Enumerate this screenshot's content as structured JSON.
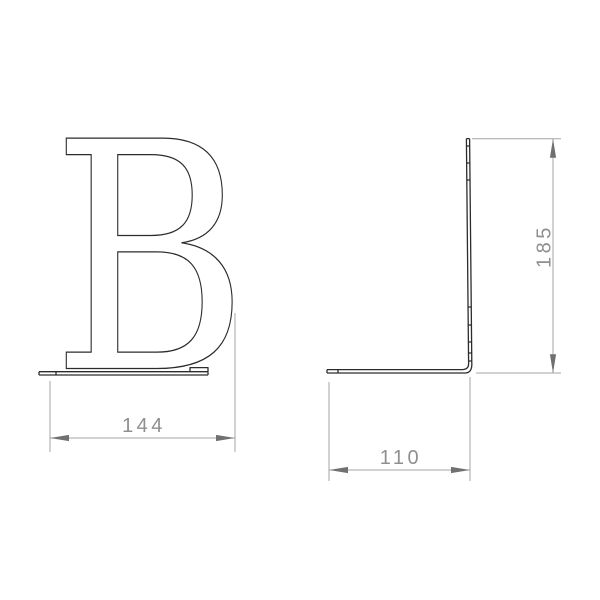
{
  "colors": {
    "background": "#ffffff",
    "part-line": "#2c2c2c",
    "dim-line": "#a6a6a6",
    "dim-arrow": "#707070",
    "dim-text": "#8f8f8f"
  },
  "drawing": {
    "letter": "B",
    "dimensions": {
      "front_width": "144",
      "side_height": "185",
      "side_depth": "110"
    }
  }
}
